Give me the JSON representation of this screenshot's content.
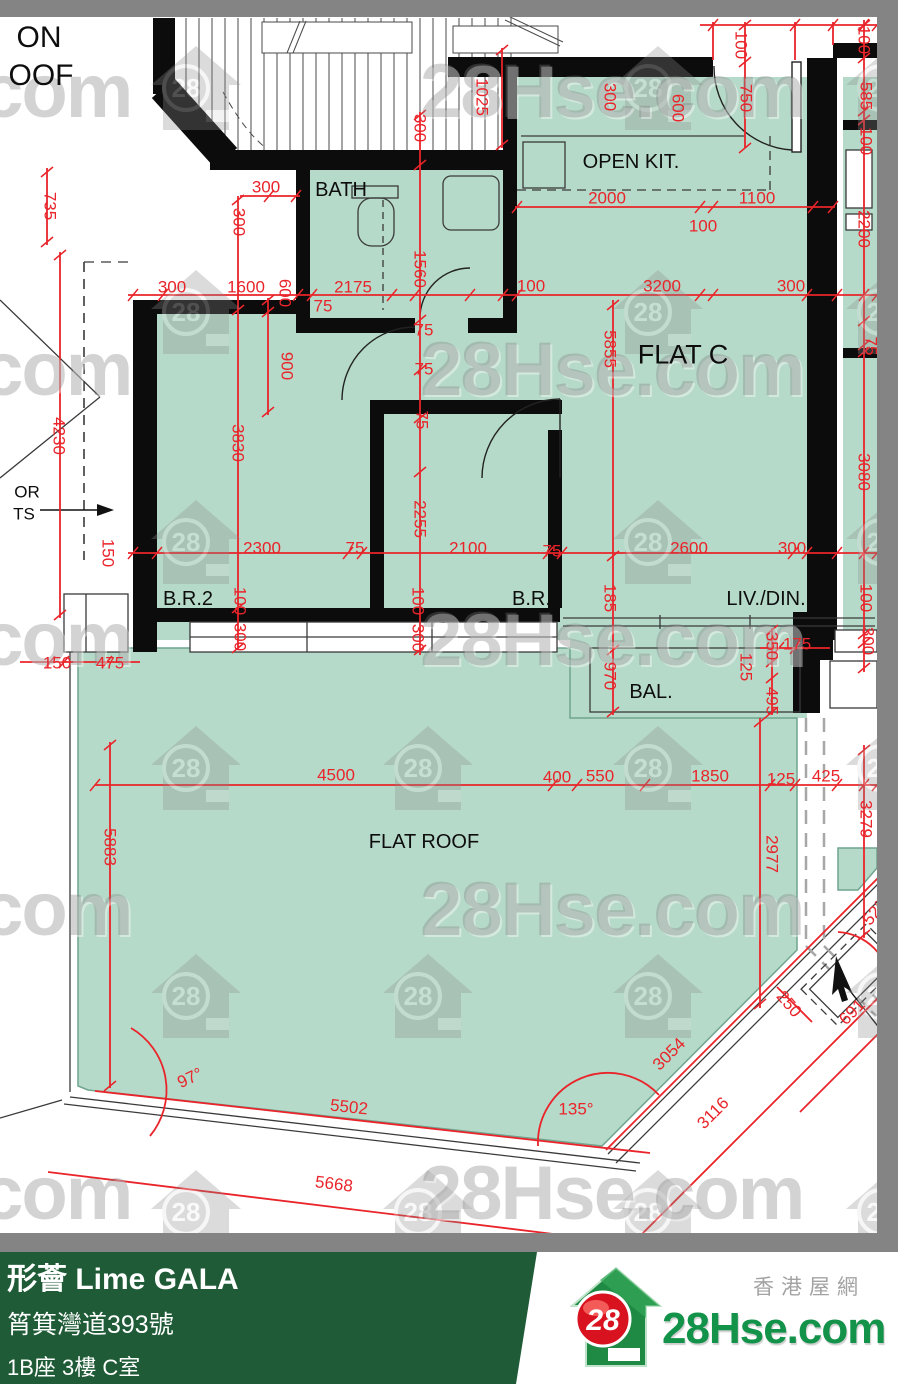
{
  "plan": {
    "colors": {
      "room_fill": "#b6dac9",
      "dimension_red": "#e9242a",
      "wall_black": "#0c0c0c",
      "footer_green": "#1e5b36"
    },
    "room_labels": [
      {
        "text": "ON",
        "x": 39,
        "y": 38,
        "size": 30
      },
      {
        "text": "OOF",
        "x": 41,
        "y": 76,
        "size": 30
      },
      {
        "text": "BATH",
        "x": 341,
        "y": 190,
        "size": 20
      },
      {
        "text": "OPEN KIT.",
        "x": 631,
        "y": 162,
        "size": 20
      },
      {
        "text": "FLAT C",
        "x": 683,
        "y": 355,
        "size": 27
      },
      {
        "text": "B.R.2",
        "x": 188,
        "y": 599,
        "size": 20
      },
      {
        "text": "B.R.1",
        "x": 537,
        "y": 599,
        "size": 20
      },
      {
        "text": "LIV./DIN.",
        "x": 766,
        "y": 599,
        "size": 20
      },
      {
        "text": "BAL.",
        "x": 651,
        "y": 692,
        "size": 20
      },
      {
        "text": "FLAT ROOF",
        "x": 424,
        "y": 842,
        "size": 20
      },
      {
        "text": "OR",
        "x": 27,
        "y": 492,
        "size": 17
      },
      {
        "text": "TS",
        "x": 24,
        "y": 514,
        "size": 17
      }
    ],
    "dim_labels": [
      {
        "t": "735",
        "x": 50,
        "y": 206,
        "r": 90
      },
      {
        "t": "300",
        "x": 266,
        "y": 187
      },
      {
        "t": "300",
        "x": 239,
        "y": 222,
        "r": 90
      },
      {
        "t": "300",
        "x": 172,
        "y": 287
      },
      {
        "t": "1600",
        "x": 246,
        "y": 287
      },
      {
        "t": "600",
        "x": 285,
        "y": 293,
        "r": 90
      },
      {
        "t": "75",
        "x": 323,
        "y": 306
      },
      {
        "t": "2175",
        "x": 353,
        "y": 287
      },
      {
        "t": "1560",
        "x": 420,
        "y": 269,
        "r": 90
      },
      {
        "t": "300",
        "x": 420,
        "y": 128,
        "r": 90
      },
      {
        "t": "1025",
        "x": 482,
        "y": 97,
        "r": 90
      },
      {
        "t": "300",
        "x": 610,
        "y": 97,
        "r": 90
      },
      {
        "t": "600",
        "x": 678,
        "y": 108,
        "r": 90
      },
      {
        "t": "100",
        "x": 741,
        "y": 45,
        "r": 90
      },
      {
        "t": "750",
        "x": 746,
        "y": 98,
        "r": 90
      },
      {
        "t": "100",
        "x": 864,
        "y": 40,
        "r": 90
      },
      {
        "t": "585",
        "x": 866,
        "y": 96,
        "r": 90
      },
      {
        "t": "100",
        "x": 866,
        "y": 141,
        "r": 90
      },
      {
        "t": "2000",
        "x": 607,
        "y": 198
      },
      {
        "t": "1100",
        "x": 757,
        "y": 198
      },
      {
        "t": "100",
        "x": 703,
        "y": 226
      },
      {
        "t": "2200",
        "x": 864,
        "y": 229,
        "r": 90
      },
      {
        "t": "100",
        "x": 531,
        "y": 286
      },
      {
        "t": "3200",
        "x": 662,
        "y": 286
      },
      {
        "t": "300",
        "x": 791,
        "y": 286
      },
      {
        "t": "5855",
        "x": 610,
        "y": 349,
        "r": 90
      },
      {
        "t": "75",
        "x": 871,
        "y": 346,
        "r": 90
      },
      {
        "t": "900",
        "x": 287,
        "y": 366,
        "r": 90
      },
      {
        "t": "75",
        "x": 424,
        "y": 330
      },
      {
        "t": "75",
        "x": 424,
        "y": 369
      },
      {
        "t": "75",
        "x": 422,
        "y": 420,
        "r": 90
      },
      {
        "t": "3080",
        "x": 864,
        "y": 472,
        "r": 90
      },
      {
        "t": "4230",
        "x": 59,
        "y": 436,
        "r": 90
      },
      {
        "t": "3830",
        "x": 238,
        "y": 443,
        "r": 90
      },
      {
        "t": "2255",
        "x": 420,
        "y": 519,
        "r": 90
      },
      {
        "t": "150",
        "x": 108,
        "y": 553,
        "r": 90
      },
      {
        "t": "2300",
        "x": 262,
        "y": 548
      },
      {
        "t": "75",
        "x": 355,
        "y": 548
      },
      {
        "t": "2100",
        "x": 468,
        "y": 548
      },
      {
        "t": "75",
        "x": 552,
        "y": 551
      },
      {
        "t": "2600",
        "x": 689,
        "y": 548
      },
      {
        "t": "300",
        "x": 792,
        "y": 548
      },
      {
        "t": "100",
        "x": 240,
        "y": 601,
        "r": 90
      },
      {
        "t": "300",
        "x": 240,
        "y": 637,
        "r": 90
      },
      {
        "t": "100",
        "x": 418,
        "y": 601,
        "r": 90
      },
      {
        "t": "300",
        "x": 418,
        "y": 638,
        "r": 90
      },
      {
        "t": "185",
        "x": 610,
        "y": 598,
        "r": 90
      },
      {
        "t": "100",
        "x": 866,
        "y": 598,
        "r": 90
      },
      {
        "t": "300",
        "x": 868,
        "y": 641,
        "r": 90
      },
      {
        "t": "150",
        "x": 57,
        "y": 663
      },
      {
        "t": "475",
        "x": 110,
        "y": 663
      },
      {
        "t": "350",
        "x": 772,
        "y": 646,
        "r": 90
      },
      {
        "t": "175",
        "x": 797,
        "y": 644
      },
      {
        "t": "125",
        "x": 746,
        "y": 667,
        "r": 90
      },
      {
        "t": "495",
        "x": 772,
        "y": 701,
        "r": 90
      },
      {
        "t": "970",
        "x": 610,
        "y": 676,
        "r": 90
      },
      {
        "t": "4500",
        "x": 336,
        "y": 775
      },
      {
        "t": "400",
        "x": 557,
        "y": 777
      },
      {
        "t": "550",
        "x": 600,
        "y": 776
      },
      {
        "t": "1850",
        "x": 710,
        "y": 776
      },
      {
        "t": "125",
        "x": 781,
        "y": 779
      },
      {
        "t": "425",
        "x": 826,
        "y": 776
      },
      {
        "t": "5883",
        "x": 110,
        "y": 847,
        "r": 90
      },
      {
        "t": "2977",
        "x": 772,
        "y": 854,
        "r": 90
      },
      {
        "t": "3279",
        "x": 866,
        "y": 819,
        "r": 90
      },
      {
        "t": "250",
        "x": 789,
        "y": 1004,
        "r": 50
      },
      {
        "t": "691",
        "x": 852,
        "y": 1012,
        "r": -45
      },
      {
        "t": "52°",
        "x": 874,
        "y": 913,
        "r": -50
      },
      {
        "t": "97°",
        "x": 190,
        "y": 1078,
        "r": -25
      },
      {
        "t": "5502",
        "x": 349,
        "y": 1107,
        "r": 6
      },
      {
        "t": "135°",
        "x": 576,
        "y": 1109
      },
      {
        "t": "3054",
        "x": 669,
        "y": 1054,
        "r": -45
      },
      {
        "t": "3116",
        "x": 713,
        "y": 1113,
        "r": -45
      },
      {
        "t": "5668",
        "x": 334,
        "y": 1184,
        "r": 7
      }
    ]
  },
  "watermark": {
    "badge": "28",
    "brand": "28Hse.com",
    "houses": [
      [
        150,
        44
      ],
      [
        612,
        44
      ],
      [
        845,
        44
      ],
      [
        150,
        268
      ],
      [
        612,
        268
      ],
      [
        845,
        268
      ],
      [
        150,
        498
      ],
      [
        612,
        498
      ],
      [
        845,
        498
      ],
      [
        150,
        724
      ],
      [
        382,
        724
      ],
      [
        612,
        724
      ],
      [
        845,
        724
      ],
      [
        150,
        952
      ],
      [
        382,
        952
      ],
      [
        612,
        952
      ],
      [
        845,
        952
      ],
      [
        150,
        1168
      ],
      [
        382,
        1168
      ],
      [
        612,
        1168
      ],
      [
        845,
        1168
      ]
    ],
    "texts": [
      [
        -252,
        48
      ],
      [
        420,
        48
      ],
      [
        -252,
        326
      ],
      [
        420,
        326
      ],
      [
        -252,
        596
      ],
      [
        420,
        596
      ],
      [
        -252,
        866
      ],
      [
        420,
        866
      ],
      [
        -252,
        1150
      ],
      [
        420,
        1150
      ]
    ]
  },
  "footer": {
    "title": "形薈 Lime GALA",
    "address": "筲箕灣道393號",
    "unit": "1B座 3樓 C室",
    "area": "489 sqf(實用面積 Saleable Area)"
  },
  "logo": {
    "badge": "28",
    "brand": "28Hse.com",
    "tagline": "香港屋網"
  }
}
